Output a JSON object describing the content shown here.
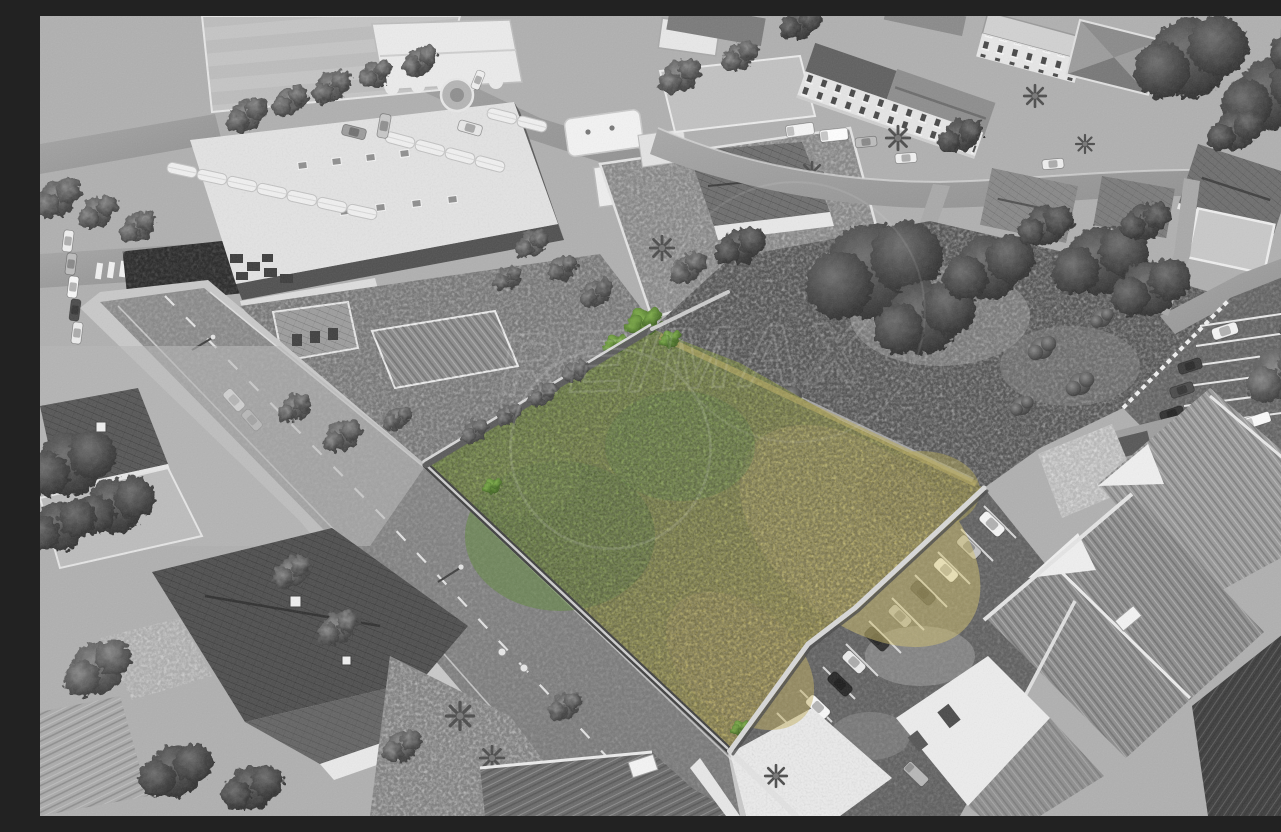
{
  "meta": {
    "title": "Aerial drone photo - vacant land plot highlighted in color",
    "type": "selective-color aerial photograph",
    "width_px": 1281,
    "height_px": 800,
    "description": "Black-and-white aerial drone view of a suburban block. A vacant overgrown plot in the centre is highlighted in natural colour (green to straw-yellow grass), enclosed by masonry walls. A two-lane road runs diagonally along its west side. Around it: a sports field and supermarket with canopied parking (top left), a gas station, apartment blocks and detached houses along the top street, gardens with pine and palm trees, a desaturated continuation of the meadow to the east, an angled car park along the plot's south-east wall and ribbed-roof terraced houses in the bottom right. A faint white RE/MAX watermark overlays the centre."
  },
  "watermark": {
    "text": "RE/MAX",
    "opacity": 0.13,
    "color": "#ffffff"
  },
  "palette": {
    "background": "#b0b0b0",
    "road": "#a0a0a0",
    "sidewalk": "#cdcdcd",
    "gravel": "#c8c8c8",
    "wall_dark": "#474747",
    "roof_light": "#dcdcdc",
    "roof_dark": "#4e4e4e",
    "field_gray": "#a6a6a6"
  },
  "plot": {
    "name": "highlighted-vacant-plot",
    "points": "612,313 700,347 800,404 944,472 815,592 768,628 690,735 386,449",
    "grass_green": "#6f9a3c",
    "grass_olive": "#9aa04a",
    "grass_straw": "#c2b156",
    "grass_deep": "#5d8a35",
    "grass_bright": "#d4c26b",
    "state": "overgrown grass, selectively coloured; everything else desaturated"
  },
  "scene": {
    "roads": {
      "main_road": "two-lane asphalt road running diagonally along the plot's walled west side",
      "top_street": "street along the northern block with parked vans",
      "left_street": "side street with zebra crossing, west edge"
    },
    "areas": {
      "sports_field": "striped pitch, top left corner",
      "supermarket": "large flat-roofed commercial building with skylights and rooftop units",
      "canopy_parking": "rows of white car-shelter canopies with parked cars",
      "gas_station": "white fuel canopy and kiosk",
      "pavilion": "white scallop-edged pavilion roof, top centre-left",
      "apartments": "three storey blocks with balconies along the top street",
      "old_house": "tile-roofed villa with chimney south of the top street",
      "gray_meadow": "desaturated continuation of the plot's meadow, north-east",
      "car_park_se": "angled parking bays with cars along the plot's south-east wall",
      "car_park_east": "small fenced car park with bays, east edge",
      "terraced_houses": "ribbed-roof terraced houses, bottom right",
      "villas_sw": "detached houses with dark tiled roofs and palm gardens, bottom left"
    },
    "counts": {
      "cars_se_car_park": 11,
      "cars_east_car_park": 6,
      "cars_parked_left_street": 5,
      "vans_top_street": 3
    }
  }
}
